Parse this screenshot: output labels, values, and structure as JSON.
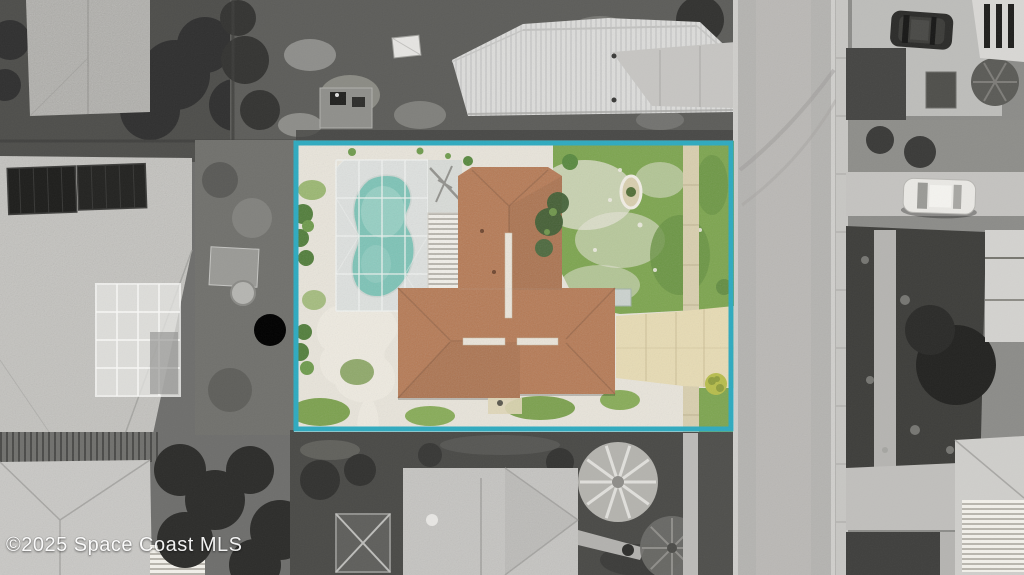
{
  "watermark": {
    "text": "©2025 Space Coast MLS"
  },
  "colors": {
    "lot_boundary": "#2faabf",
    "pool_water": "#7cc3b6",
    "pool_water_light": "#a9d8cd",
    "roof_terracotta": "#b5754d",
    "roof_ridge_line": "#8a583a",
    "ridge_vent_white": "#efe9dd",
    "grass_green": "#7ba44c",
    "grass_dark": "#679140",
    "gravel_sand": "#e9e5db",
    "driveway_concrete": "#e8dcb4",
    "sidewalk_tan": "#d9cfae",
    "road_asphalt": "#b4b3b0",
    "pool_deck": "#dde1df",
    "watermark_text": "#ffffff"
  },
  "scene": {
    "type": "aerial-drone-photo",
    "style": "surroundings desaturated to grayscale; featured lot rendered in color inside a teal boundary rectangle",
    "featured_lot_contents": [
      "single-story house with terracotta hip roof and white ridge vents",
      "screened pool enclosure with kidney-shaped teal pool",
      "white slatted lanai roof beside pool cage",
      "white sand and gravel yard",
      "green lawn on street side",
      "concrete driveway to street",
      "public sidewalk crossing front lawn",
      "small oval stone planter ring",
      "winding sand path in back yard",
      "green shrubs along west edge",
      "yellow-green bush by driveway"
    ],
    "surroundings": [
      "textured gray rooftop upper left",
      "house with dark rooftop solar panels on left",
      "screened structure on left neighbor lot",
      "light metal-roof house to the north with driveway to street",
      "equipment pad and small shed north of lot",
      "wood fence and gray hip-roof house lower left",
      "gray hip-roof house and pergola frame below lot",
      "light palm tree and dark palm tree lower middle",
      "street with curbs running down right side",
      "sidewalk and planting beds across street",
      "dark SUV parked upper right",
      "white car parked in driveway across street",
      "house walls and garages along right edge"
    ]
  }
}
